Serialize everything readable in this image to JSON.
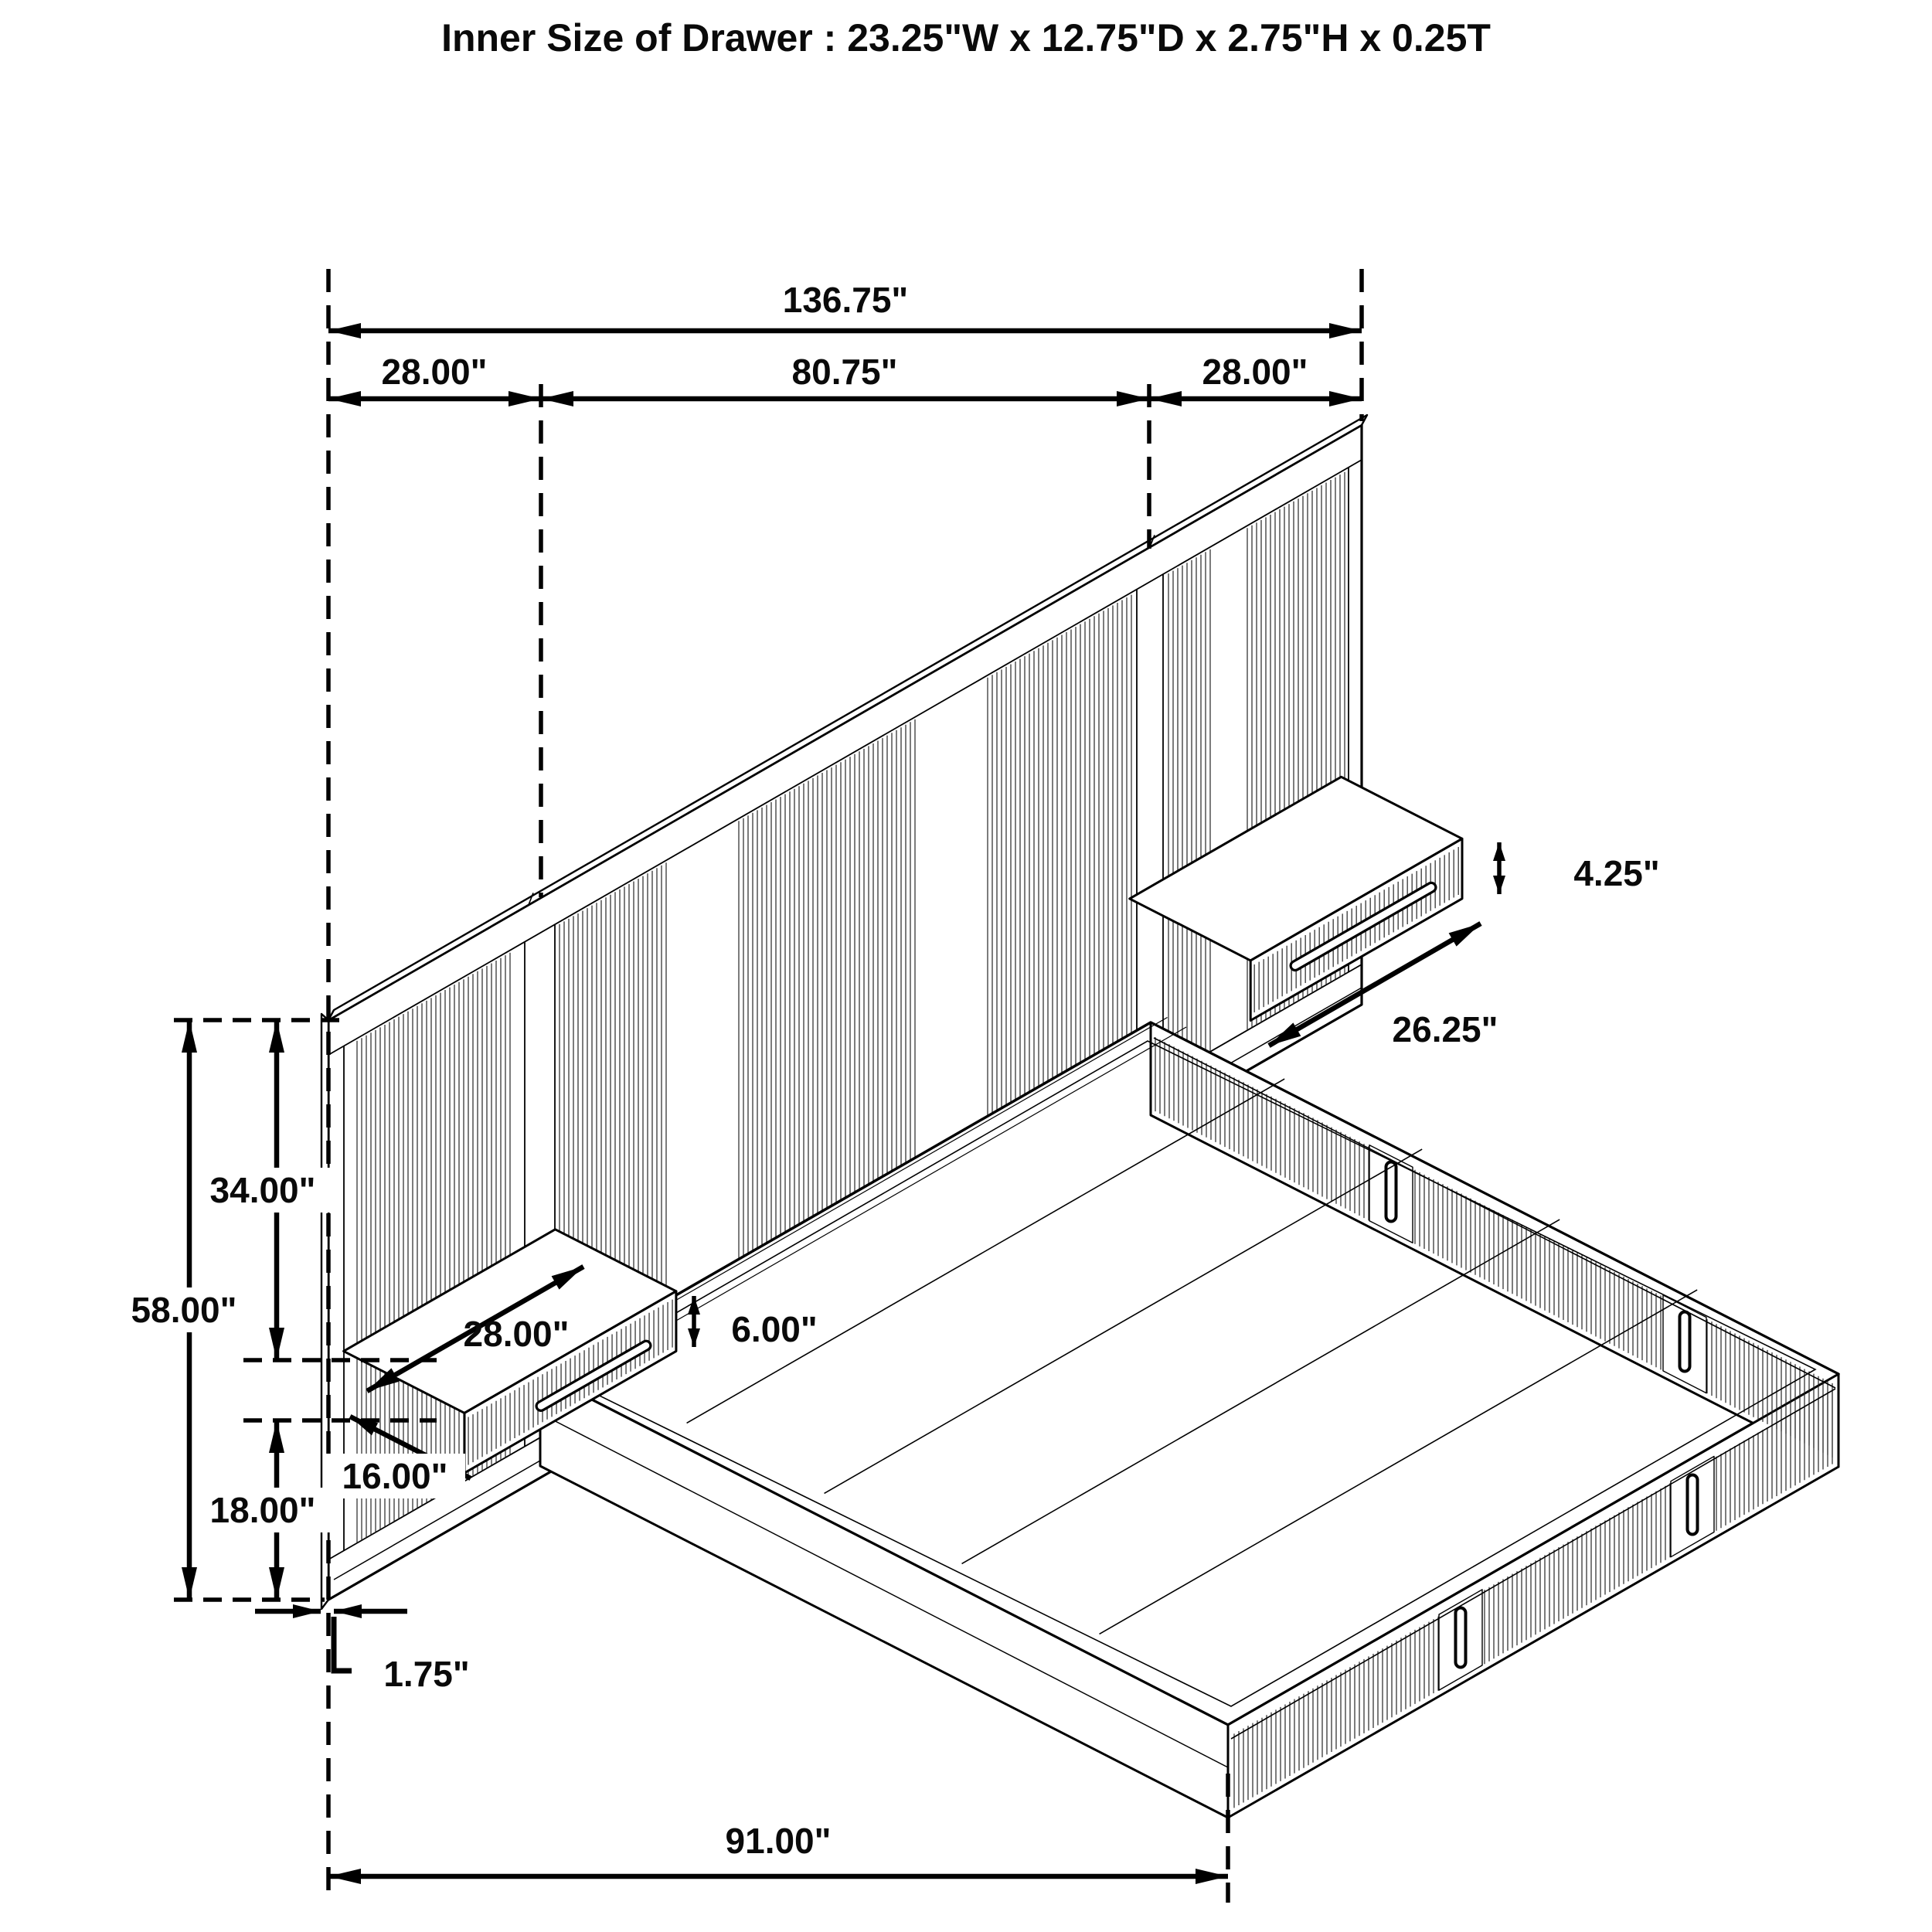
{
  "title": "Inner Size of Drawer : 23.25\"W x 12.75\"D x 2.75\"H x 0.25T",
  "diagram": {
    "subject": "wall-bed with paneled headboard, floating nightstand drawers and storage platform bed",
    "view": "isometric line drawing with dimension annotations",
    "units": "inches"
  },
  "dims": {
    "overall_width": "136.75\"",
    "left_panel_width": "28.00\"",
    "center_width": "80.75\"",
    "right_panel_width": "28.00\"",
    "headboard_height": "58.00\"",
    "upper_height": "34.00\"",
    "lower_height": "18.00\"",
    "right_nightstand_height": "4.25\"",
    "right_nightstand_width": "26.25\"",
    "left_nightstand_width": "28.00\"",
    "left_nightstand_height": "6.00\"",
    "left_nightstand_depth": "16.00\"",
    "panel_thickness": "1.75\"",
    "bed_length": "91.00\""
  }
}
